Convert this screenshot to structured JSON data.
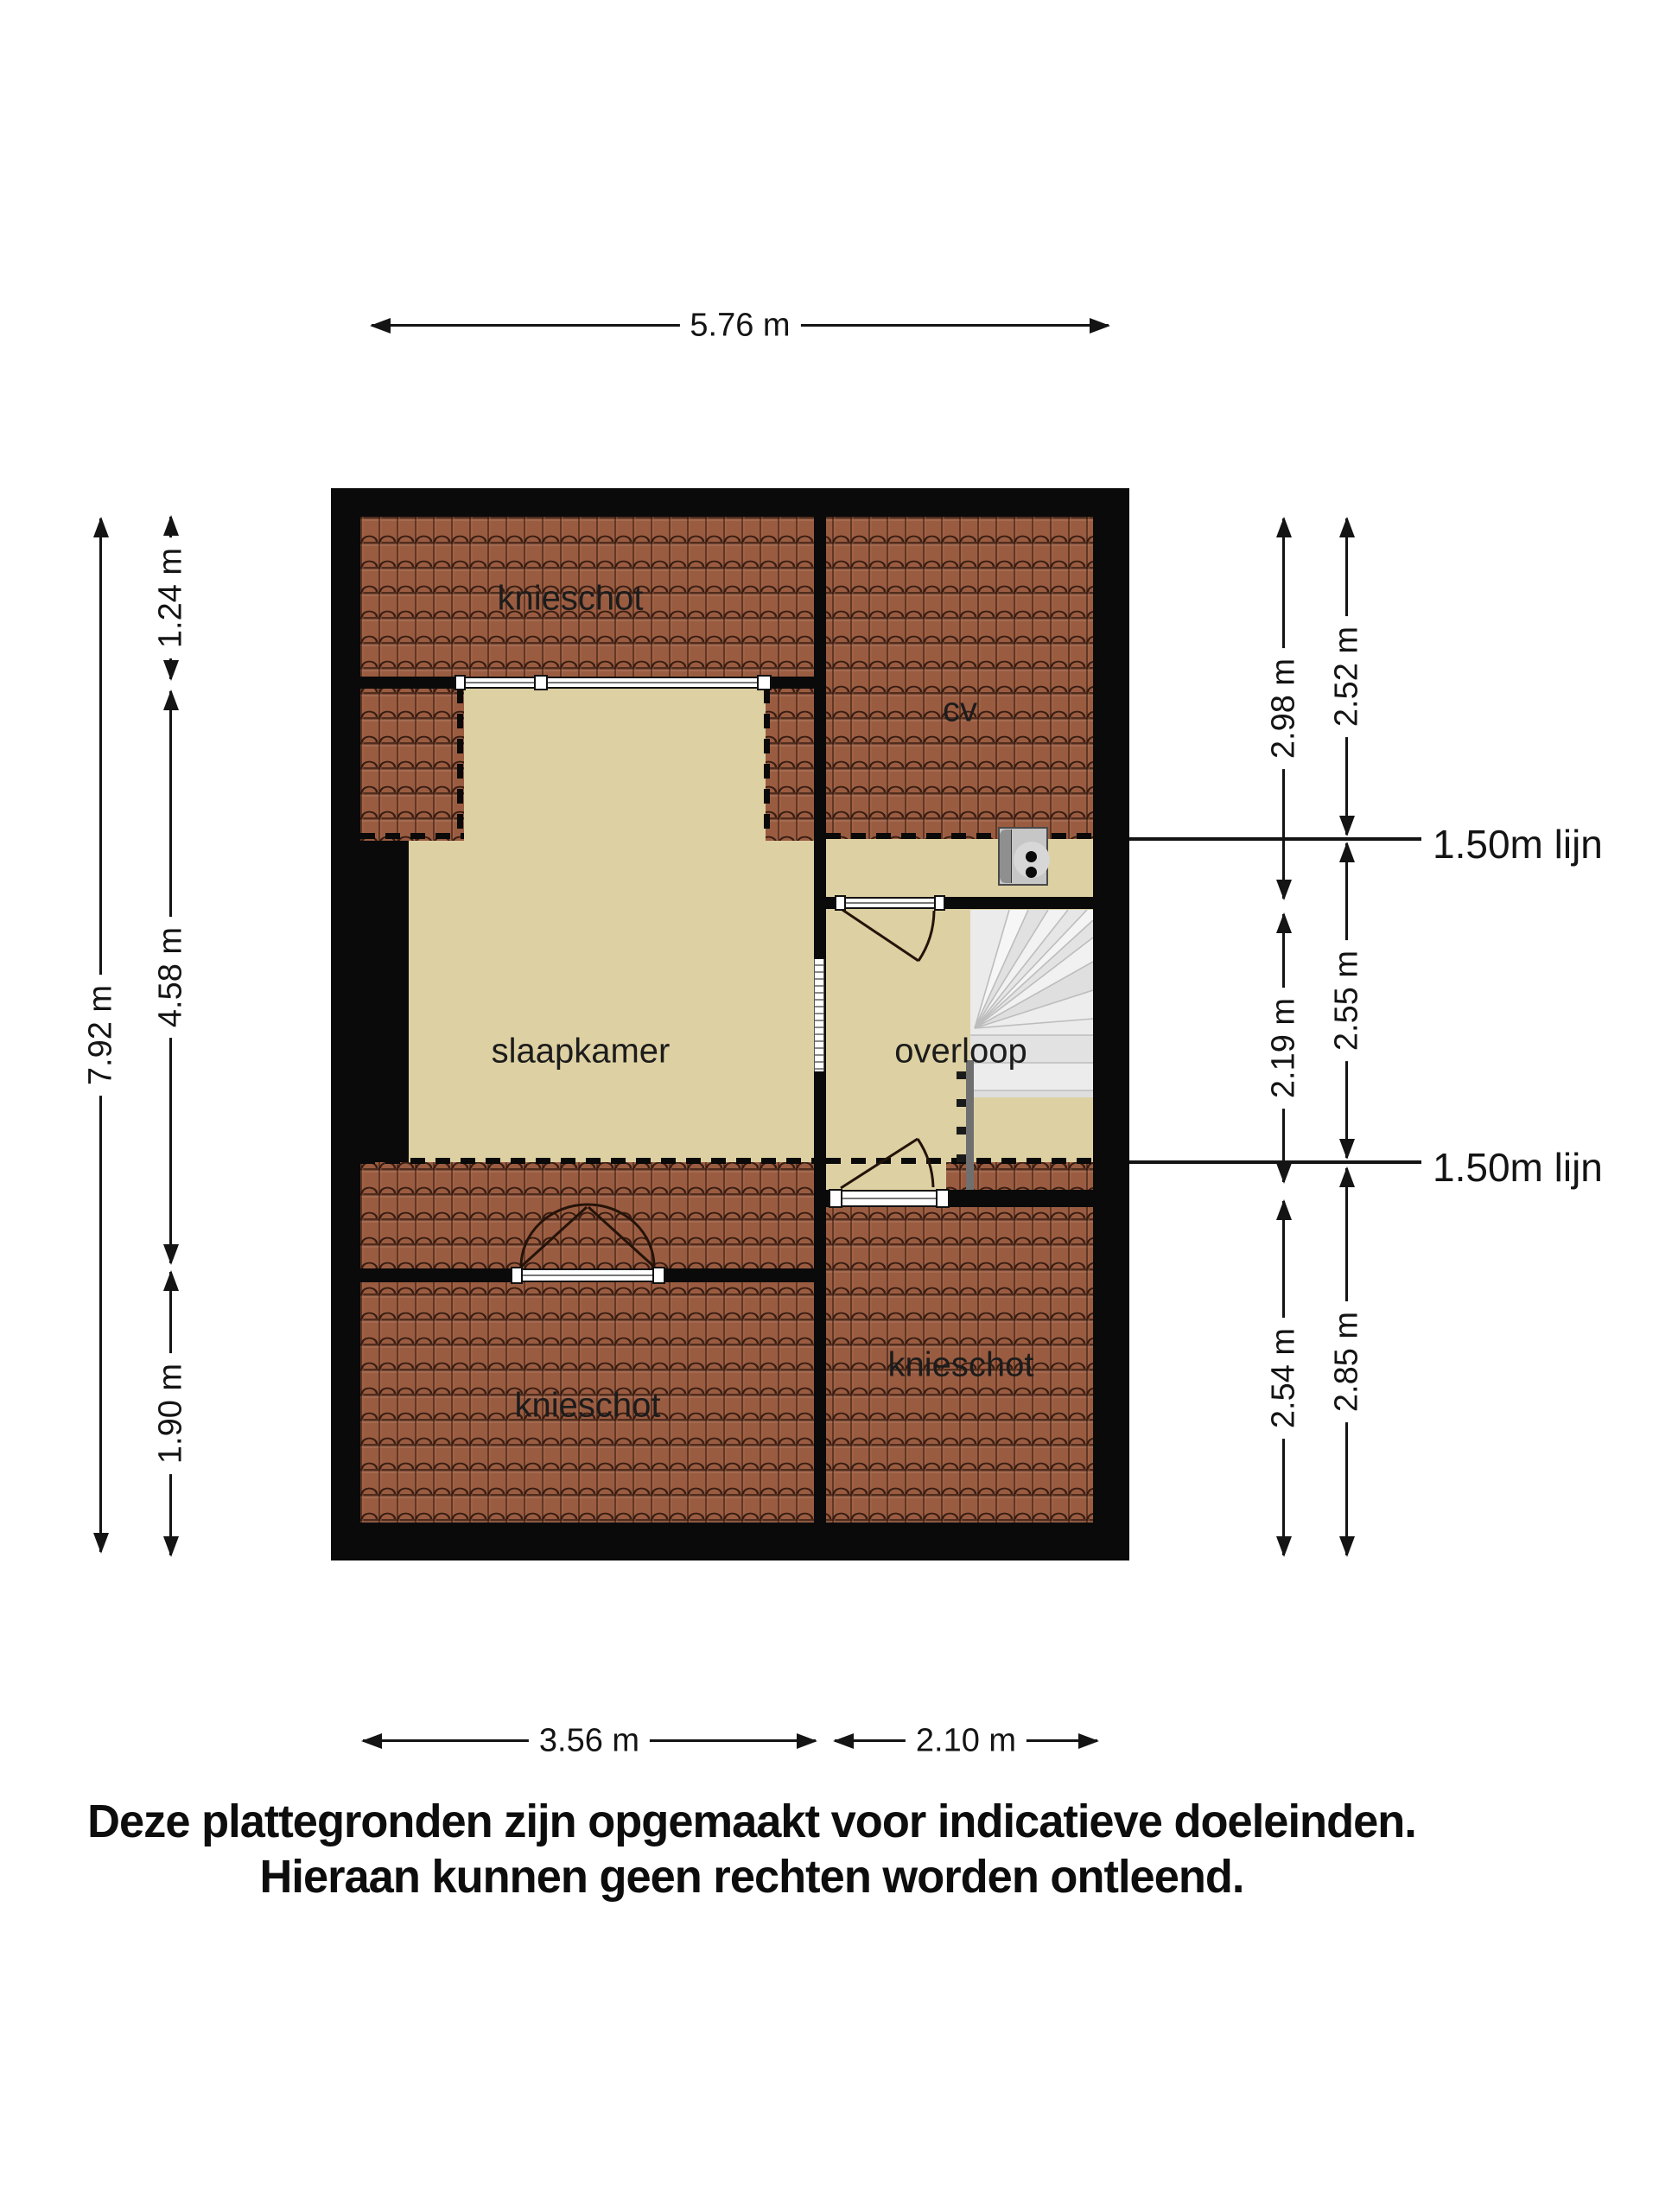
{
  "plan": {
    "rooms": {
      "knieschot_top": "knieschot",
      "cv": "cv",
      "slaapkamer": "slaapkamer",
      "overloop": "overloop",
      "knieschot_bottom_right": "knieschot",
      "knieschot_bottom_left": "knieschot"
    },
    "height_lines": {
      "line1": "1.50m lijn",
      "line2": "1.50m lijn"
    }
  },
  "dimensions": {
    "top": "5.76 m",
    "left_outer": "7.92 m",
    "left_inner": [
      "1.24 m",
      "4.58 m",
      "1.90 m"
    ],
    "right_inner": [
      "2.98 m",
      "2.19 m",
      "2.54 m"
    ],
    "right_outer": [
      "2.52 m",
      "2.55 m",
      "2.85 m"
    ],
    "bottom": [
      "3.56 m",
      "2.10 m"
    ]
  },
  "disclaimer": {
    "line1": "Deze plattegronden zijn opgemaakt voor indicatieve doeleinden.",
    "line2": "Hieraan kunnen geen rechten worden ontleend."
  },
  "colors": {
    "wall": "#0a0a0a",
    "roof_tile": "#9a5c41",
    "floor": "#ddd0a2",
    "stairs": "#e9e9e9",
    "accent_text": "#141414"
  }
}
